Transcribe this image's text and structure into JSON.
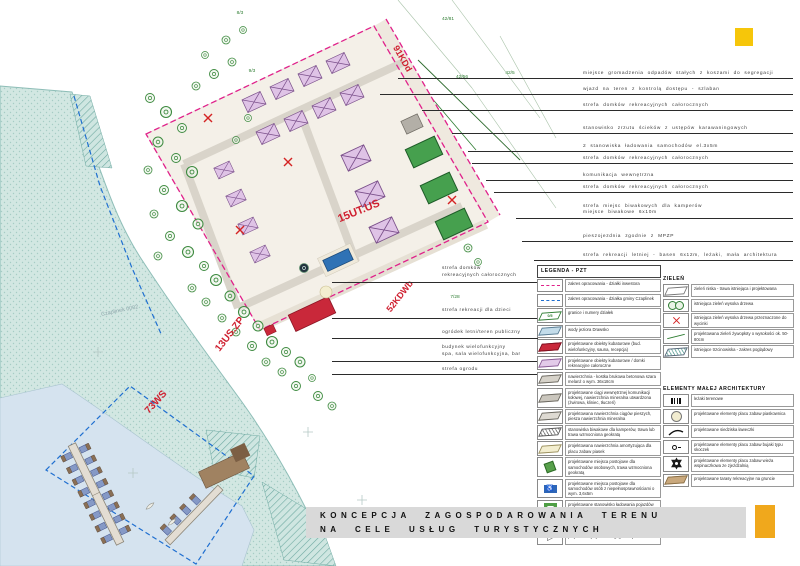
{
  "page": {
    "title_line1": "KONCEPCJA ZAGOSPODAROWANIA TERENU",
    "title_line2": "NA CELE USŁUG TURYSTYCZNYCH"
  },
  "plan": {
    "zones": {
      "kdd": "91KDd",
      "utus": "15UT.US",
      "kdwb": "52KDWb",
      "uszp": "13US.ZP",
      "ws": "73WS"
    },
    "cadastre_label": "Czaplinek 0002",
    "parcels": [
      "8/3",
      "9/3",
      "42/81",
      "42/56",
      "42/5",
      "7/28"
    ]
  },
  "annotations_right": [
    {
      "text": "miejsce gromadzenia odpadów stałych z koszami do segregacji"
    },
    {
      "text": "wjazd na teren z kontrolą dostępu - szlaban"
    },
    {
      "text": "strefa domków rekreacyjnych całorocznych"
    },
    {
      "text": "stanowisko zrzutu ścieków z ustępów karawaningowych"
    },
    {
      "text": "2 stanowiska ładowania samochodów el.3x5m"
    },
    {
      "text": "strefa domków rekreacyjnych całorocznych"
    },
    {
      "text": "komunikacja wewnętrzna"
    },
    {
      "text": "strefa domków rekreacyjnych całorocznych"
    },
    {
      "text": "strefa miejsc biwakowych dla kamperów\nmiejsce biwakowe 6x10m"
    },
    {
      "text": "pieszojezdnia zgodnie z MPZP"
    },
    {
      "text": "strefa rekreacji letniej - basen 6x12m, leżaki, mała architektura"
    }
  ],
  "annotations_left": [
    {
      "text": "strefa domków\nrekreacyjnych całorocznych"
    },
    {
      "text": "strefa rekreacji dla dzieci"
    },
    {
      "text": "ogródek letni/teren publiczny"
    },
    {
      "text": "budynek wielofunkcyjny\nspa, sala wielofunkcyjna, bar"
    },
    {
      "text": "strefa ogrodu"
    }
  ],
  "legend_pzt": {
    "title": "LEGENDA - PZT",
    "items": [
      {
        "icon": "magenta-dashed-line",
        "label": "zakres opracowania - działki inwestora"
      },
      {
        "icon": "blue-dashed-line",
        "label": "zakres opracowania - działka gminy Czaplinek"
      },
      {
        "icon": "parcel-boundary",
        "icon_text": "0/5",
        "label": "granice i numery działek"
      },
      {
        "icon": "water-swatch",
        "label": "wody jeziora Drawsko"
      },
      {
        "icon": "red-building-swatch",
        "label": "projektowane obiekty kubaturowe (bud. wielofunkcyjny, sauna, recepcja)"
      },
      {
        "icon": "lavender-building-swatch",
        "label": "projektowane obiekty kubaturowe / domki rekreacyjne całoroczne"
      },
      {
        "icon": "gray-paver-swatch",
        "label": "nawierzchnia - kostka brukowa betonowa szara melanż o wym. 36x18cm"
      },
      {
        "icon": "gray-road-swatch",
        "label": "projektowane ciągi wewnętrznej komunikacji kołowej, nawierzchnia mineralna utwardzona (żwirowa, kliniec, tłuczeń)"
      },
      {
        "icon": "gray-path-swatch",
        "label": "projektowana nawierzchnia ciągów pieszych, piesza nawierzchnia mineralna"
      },
      {
        "icon": "hatched-camper-swatch",
        "label": "stanowiska biwakowe dla kamperów, trawa lub trawa wzmocniona geokratą"
      },
      {
        "icon": "sand-swatch",
        "label": "projektowana nawierzchnia amortyzująca dla placu zabaw piasek"
      },
      {
        "icon": "green-parking-swatch",
        "label": "projektowane miejsca postojowe dla samochodów osobowych, trawa wzmocniona geokratą"
      },
      {
        "icon": "disabled-parking",
        "glyph": "♿",
        "label": "projektowane miejsca postojowe dla samochodów osób z niepełnosprawnościami o wym. 3,6x5m"
      },
      {
        "icon": "ev-charging",
        "label": "projektowane stanowisko ładowania pojazdów el. z 2 bankami energii"
      },
      {
        "icon": "waste-area",
        "label": "projektowane utwardzenie terenu, miejsce gromadzenia odpadów - śmietnik"
      },
      {
        "icon": "road-exit-flag",
        "glyph": "▷",
        "label": "projektowany zjazd z drogi gminnej"
      }
    ]
  },
  "legend_zielen": {
    "title": "ZIELEŃ",
    "items": [
      {
        "icon": "grass-swatch",
        "label": "zieleń niska - trawa istniejąca i projektowana"
      },
      {
        "icon": "trees",
        "label": "istniejąca zieleń wysoka drzewa"
      },
      {
        "icon": "tree-removal-x",
        "label": "istniejąca zieleń wysoka drzewa przeznaczone do wycinki"
      },
      {
        "icon": "hedge-line",
        "label": "projektowana zieleń żywopłoty o wysokości ok. 50-80cm"
      },
      {
        "icon": "reeds-hatch",
        "label": "istniejące trzcinowiska - zakres poglądowy"
      }
    ]
  },
  "legend_mala": {
    "title": "ELEMENTY MAŁEJ ARCHITEKTURY",
    "items": [
      {
        "icon": "sunbeds",
        "label": "leżaki terenowe"
      },
      {
        "icon": "sandbox-circle",
        "label": "projektowane elementy placu zabaw piaskownica"
      },
      {
        "icon": "bench-curve",
        "label": "projektowane siedziska ławeczki"
      },
      {
        "icon": "spring-rider",
        "label": "projektowane elementy placu zabaw bujaki typu skoczek"
      },
      {
        "icon": "climbing-tower",
        "label": "projektowane elementy placu zabaw wieża wspinaczkowa ze zjeżdżalnią"
      },
      {
        "icon": "terrace-swatch",
        "label": "projektowane tarasy rekreacyjne na gruncie"
      }
    ]
  },
  "colors": {
    "boundary_investor": "#e0218a",
    "boundary_gmina": "#1f6fd0",
    "zone_label_red": "#cf2030",
    "water_teal": "#d2e7e2",
    "accent_yellow_top": "#f6c60a",
    "accent_yellow_bottom": "#f0a81c"
  }
}
